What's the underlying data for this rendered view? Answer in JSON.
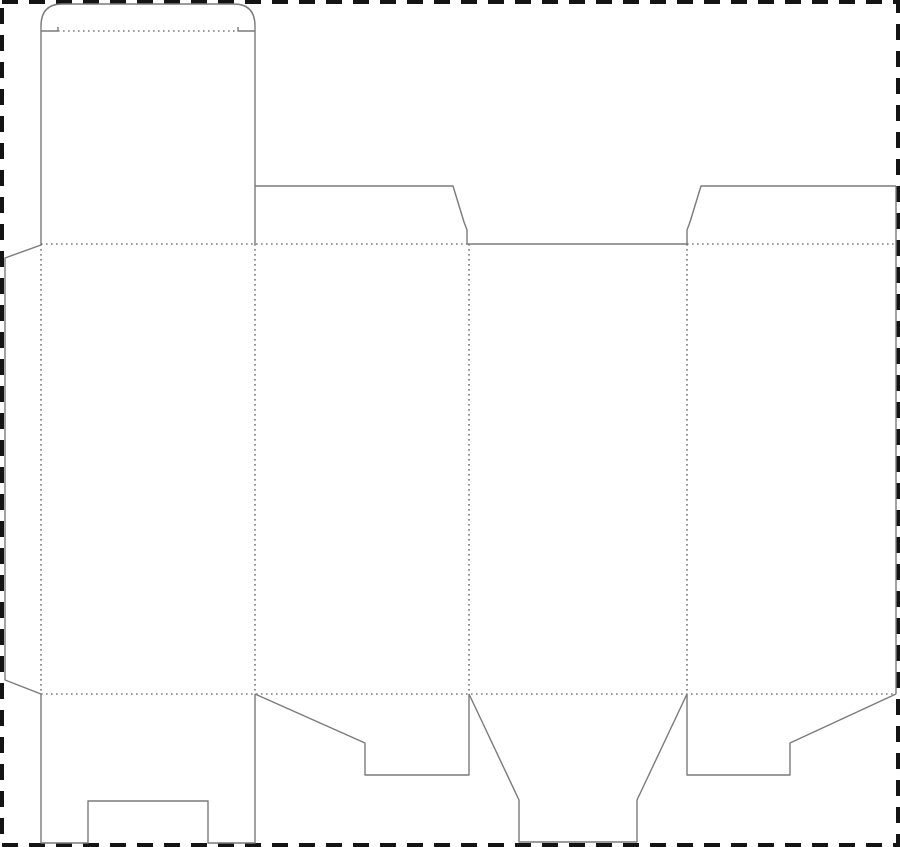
{
  "meta": {
    "description": "Folding carton box dieline template (tuck-top, snap-lock bottom) with cut lines, dotted fold lines and dashed trim border",
    "canvas": {
      "width": 900,
      "height": 847
    },
    "background": "#ffffff"
  },
  "colors": {
    "cut": "#7a7a7a",
    "fold": "#3a3a3a",
    "border": "#141414"
  },
  "border": {
    "x": 2,
    "y": 2,
    "width": 896,
    "height": 843,
    "stroke_width": 4,
    "dash": "16 11"
  },
  "stroke": {
    "cut_width": 1.4,
    "fold_width": 1.1,
    "fold_dash": "1.6 3.4"
  },
  "cut_lines": [
    {
      "name": "tuck-flap-outline",
      "d": "M41,31 L41,26 Q41,4 62,4 L234,4 Q255,4 255,26 L255,31"
    },
    {
      "name": "tuck-shoulder-left",
      "d": "M41,31 L58,31 L58,27"
    },
    {
      "name": "tuck-shoulder-right",
      "d": "M255,31 L238,31 L238,27"
    },
    {
      "name": "lid-panel-side-left",
      "d": "M41,31 L41,244"
    },
    {
      "name": "lid-panel-side-right",
      "d": "M255,31 L255,244"
    },
    {
      "name": "glue-flap-edge",
      "d": "M41,245 L5,258 L5,680 L41,694"
    },
    {
      "name": "top-dust-flap-left",
      "d": "M255,186 L453,186 L464,222 L467,230 L467,244"
    },
    {
      "name": "top-opening-cut",
      "d": "M467,244 L687,244"
    },
    {
      "name": "top-dust-flap-right",
      "d": "M687,244 L687,230 L690,222 L701,186 L896,186"
    },
    {
      "name": "sheet-right-edge",
      "d": "M896,186 L896,694"
    },
    {
      "name": "bottom-lock-flap",
      "d": "M41,694 L41,843 L88,843 L88,801 L208,801 L208,843 L255,843 L255,694"
    },
    {
      "name": "bottom-hook-flap-left",
      "d": "M255,694 L365,743 L365,775 L469,775 L469,694"
    },
    {
      "name": "bottom-tongue-flap",
      "d": "M469,694 L519,800 L519,842 L637,842 L637,800 L687,694"
    },
    {
      "name": "bottom-hook-flap-right",
      "d": "M687,694 L687,775 L790,775 L790,743 L896,694"
    }
  ],
  "fold_lines": [
    {
      "name": "tuck-fold",
      "d": "M58,31 L238,31"
    },
    {
      "name": "top-fold-left-section",
      "d": "M41,244 L467,244"
    },
    {
      "name": "top-fold-right-section",
      "d": "M687,244 L896,244"
    },
    {
      "name": "bottom-fold",
      "d": "M41,694 L896,694"
    },
    {
      "name": "glue-flap-fold",
      "d": "M41,244 L41,694"
    },
    {
      "name": "panel-fold-1-2",
      "d": "M255,244 L255,694"
    },
    {
      "name": "panel-fold-2-3",
      "d": "M469,244 L469,694"
    },
    {
      "name": "panel-fold-3-4",
      "d": "M687,244 L687,694"
    }
  ]
}
